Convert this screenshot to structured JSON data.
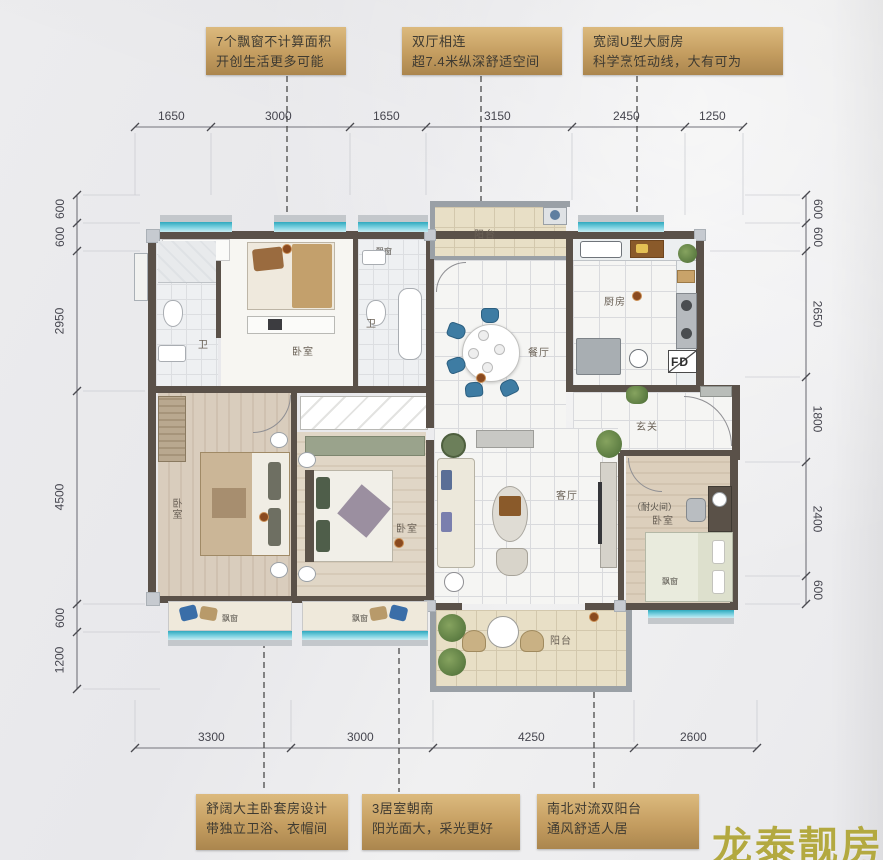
{
  "annotations": {
    "top": [
      {
        "line1": "7个飘窗不计算面积",
        "line2": "开创生活更多可能"
      },
      {
        "line1": "双厅相连",
        "line2": "超7.4米纵深舒适空间"
      },
      {
        "line1": "宽阔U型大厨房",
        "line2": "科学烹饪动线，大有可为"
      }
    ],
    "bottom": [
      {
        "line1": "舒阔大主卧套房设计",
        "line2": "带独立卫浴、衣帽间"
      },
      {
        "line1": "3居室朝南",
        "line2": "阳光面大，采光更好"
      },
      {
        "line1": "南北对流双阳台",
        "line2": "通风舒适人居"
      }
    ]
  },
  "dimensions": {
    "top": [
      "1650",
      "3000",
      "1650",
      "3150",
      "2450",
      "1250"
    ],
    "bottom": [
      "3300",
      "3000",
      "4250",
      "2600"
    ],
    "left": [
      "600",
      "600",
      "2950",
      "4500",
      "600",
      "1200"
    ],
    "right": [
      "600",
      "600",
      "2650",
      "1800",
      "2400",
      "600"
    ]
  },
  "labels": {
    "balcony": "阳台",
    "kitchen": "厨房",
    "dining": "餐厅",
    "living": "客厅",
    "hall": "玄关",
    "bedroom": "卧室",
    "bath": "卫",
    "bay_window": "飘窗",
    "fire_room": "（耐火间）",
    "flue": "FD"
  },
  "watermark": "龙泰靓房",
  "colors": {
    "annotation_gold": "#c49d60",
    "wall": "#5a5149",
    "bay_glass_teal": "#3fb6c9",
    "leader_dot": "#8a4a1f",
    "watermark_gold": "#b3a940",
    "chair_blue": "#3e7ca3"
  }
}
